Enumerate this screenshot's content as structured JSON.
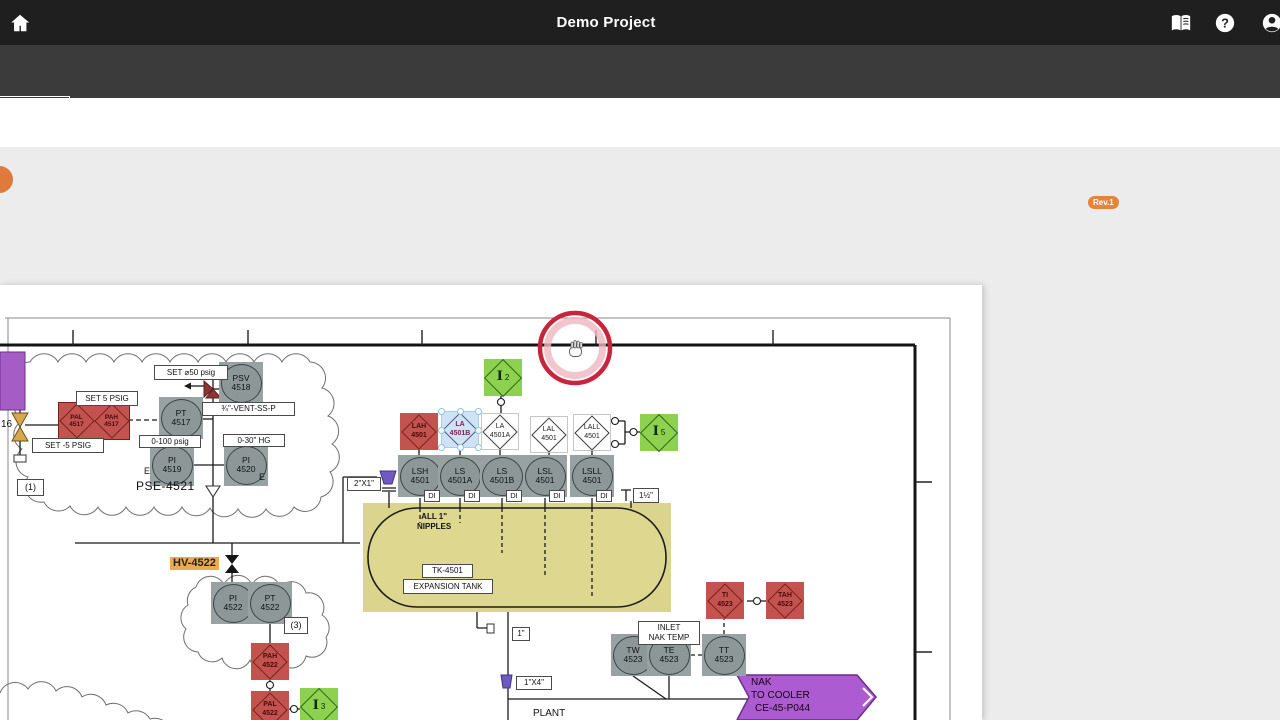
{
  "topbar": {
    "title": "Demo Project"
  },
  "tabbar": {
    "tabs": [
      "SYMBOLS",
      "TABLES",
      "TEXT"
    ],
    "save_button": "Save as template"
  },
  "toolbar": {
    "tools": [
      {
        "label": "Annotate"
      },
      {
        "label": "Group"
      },
      {
        "label": "Merge"
      },
      {
        "label": "Coverage"
      },
      {
        "label": "Print"
      },
      {
        "label": "Download"
      }
    ],
    "doc_name": "CE-45-P045",
    "replace_label": "Replace",
    "revision_label": "Revision",
    "revision_badge": "Rev.1",
    "page_number": "1",
    "page_separator": "/"
  },
  "diagram": {
    "instruments": {
      "pt4517": [
        "PT",
        "4517"
      ],
      "psv4518": [
        "PSV",
        "4518"
      ],
      "pi4519": [
        "PI",
        "4519"
      ],
      "pi4520": [
        "PI",
        "4520"
      ],
      "pal4517": [
        "PAL",
        "4517"
      ],
      "pah4517": [
        "PAH",
        "4517"
      ],
      "lah4501": [
        "LAH",
        "4501"
      ],
      "la4501b": [
        "LA",
        "4501B"
      ],
      "la4501a": [
        "LA",
        "4501A"
      ],
      "lal4501": [
        "LAL",
        "4501"
      ],
      "lall4501": [
        "LALL",
        "4501"
      ],
      "lsh4501": [
        "LSH",
        "4501"
      ],
      "ls4501a": [
        "LS",
        "4501A"
      ],
      "ls4501b": [
        "LS",
        "4501B"
      ],
      "lsl4501": [
        "LSL",
        "4501"
      ],
      "lsll4501": [
        "LSLL",
        "4501"
      ],
      "pi4522": [
        "PI",
        "4522"
      ],
      "pt4522": [
        "PT",
        "4522"
      ],
      "pah4522": [
        "PAH",
        "4522"
      ],
      "pal4522": [
        "PAL",
        "4522"
      ],
      "tw4523": [
        "TW",
        "4523"
      ],
      "te4523": [
        "TE",
        "4523"
      ],
      "tt4523": [
        "TT",
        "4523"
      ],
      "ti4523": [
        "TI",
        "4523"
      ],
      "tah4523": [
        "TAH",
        "4523"
      ]
    },
    "interlocks": {
      "i2": [
        "I",
        "2"
      ],
      "i5": [
        "I",
        "5"
      ],
      "i3": [
        "I",
        "3"
      ]
    },
    "labels": {
      "set5": "SET 5 PSIG",
      "setm5": "SET -5 PSIG",
      "set50": "SET ⌀50 psig",
      "r100": "0-100 psig",
      "r30": "0-30\" HG",
      "vent": "¾\"-VENT-SS-P",
      "note1": "(1)",
      "note3": "(3)",
      "v16": "16",
      "e": "E",
      "pse": "PSE-4521",
      "hv": "HV-4522",
      "tk": "TK-4501",
      "tank": "EXPANSION TANK",
      "nip1": "ALL 1\"",
      "nip2": "NIPPLES",
      "di": "DI",
      "s2x1": "2\"X1\"",
      "s15": "1½\"",
      "s1": "1\"",
      "s1x4": "1\"X4\"",
      "inlet1": "INLET",
      "inlet2": "NAK TEMP",
      "plant": "PLANT"
    },
    "banner": {
      "line1": "NAK",
      "line2": "TO COOLER",
      "line3": "CE-45-P044"
    }
  }
}
